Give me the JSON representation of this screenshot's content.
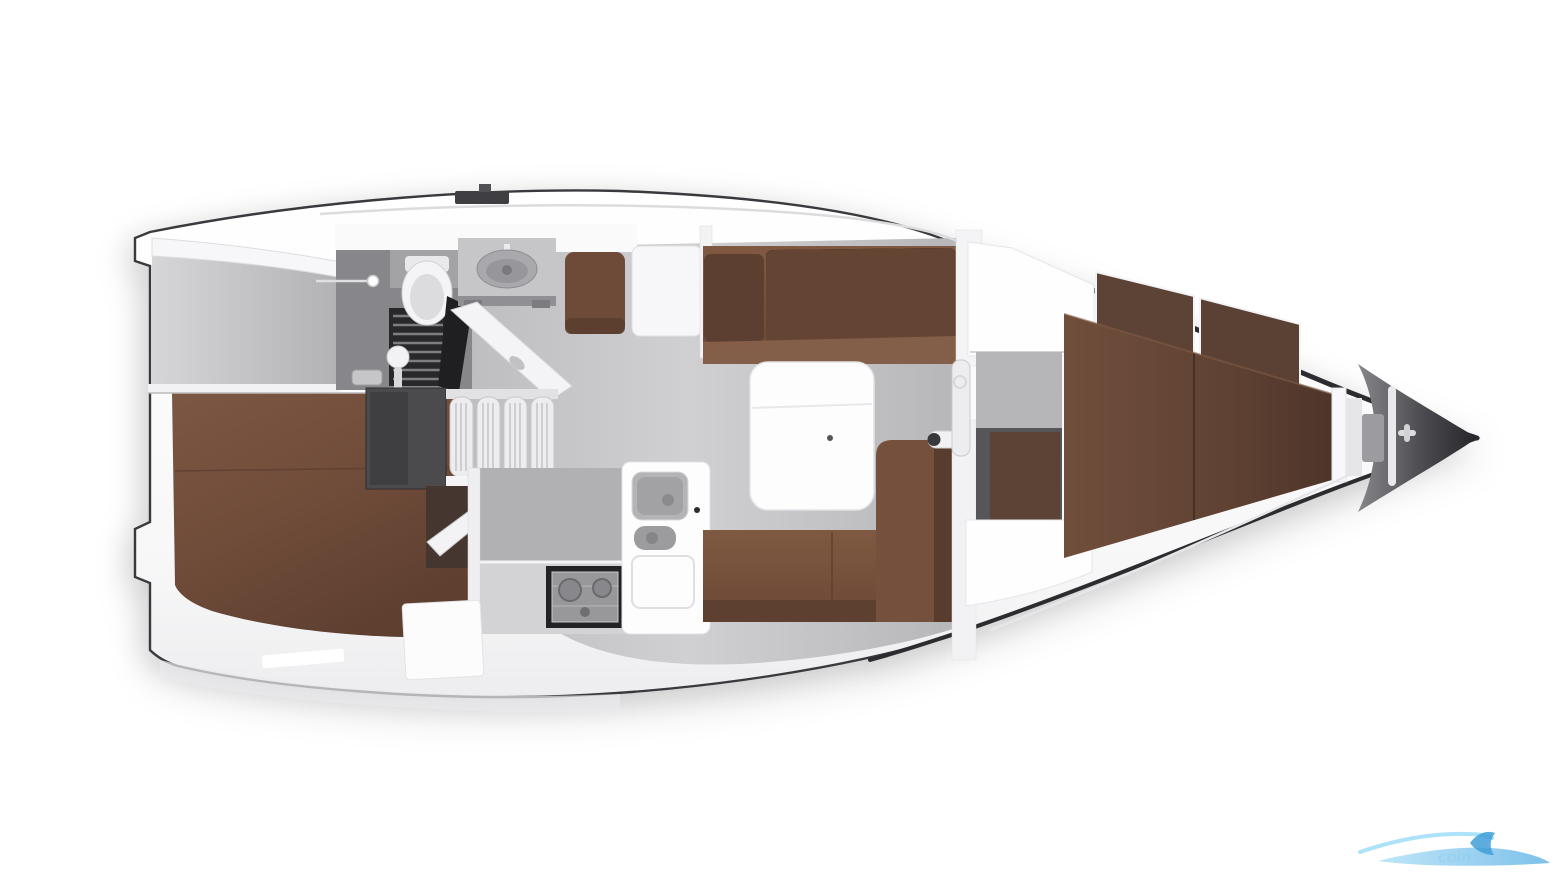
{
  "page": {
    "title": "Sailing yacht interior floor plan — top-down cutaway view",
    "background": "#ffffff"
  },
  "watermark": {
    "text": "com",
    "color_light": "#a5dcf6",
    "color_mid": "#7cc5ee",
    "color_dark": "#3f9fd8"
  },
  "colors": {
    "deck_white": "#fbfbfc",
    "hull_outline": "#3a3a3e",
    "sheer_dark": "#2c2c30",
    "stern_gray": "#c9c9cc",
    "cockpit_band": "#f7f7f9",
    "floor_gray": "#c6c6c9",
    "corridor_gray": "#b6b6b9",
    "galley_face_gray": "#b1b1b4",
    "counter_gray": "#d3d3d5",
    "aft_berth_brown": "#755140",
    "sofa_brown": "#7a553f",
    "sofa_back_brown": "#5c3f30",
    "chart_seat_brown": "#6d4b38",
    "vberth_brown": "#6d4b3a",
    "wardrobe_brown": "#5d4335",
    "niche_panel_brown": "#5d4335",
    "locker_dark": "#4b4b4e",
    "niche_dark": "#56565a",
    "door_recess_dark": "#453630",
    "grate_dark": "#28282b",
    "stove_dark": "#232326",
    "fitting_white": "#f3f3f5",
    "table_white": "#fdfdfe",
    "cabinet_white": "#fefeff",
    "sink_gray": "#a9a9ad",
    "toilet_white": "#f4f4f6"
  }
}
